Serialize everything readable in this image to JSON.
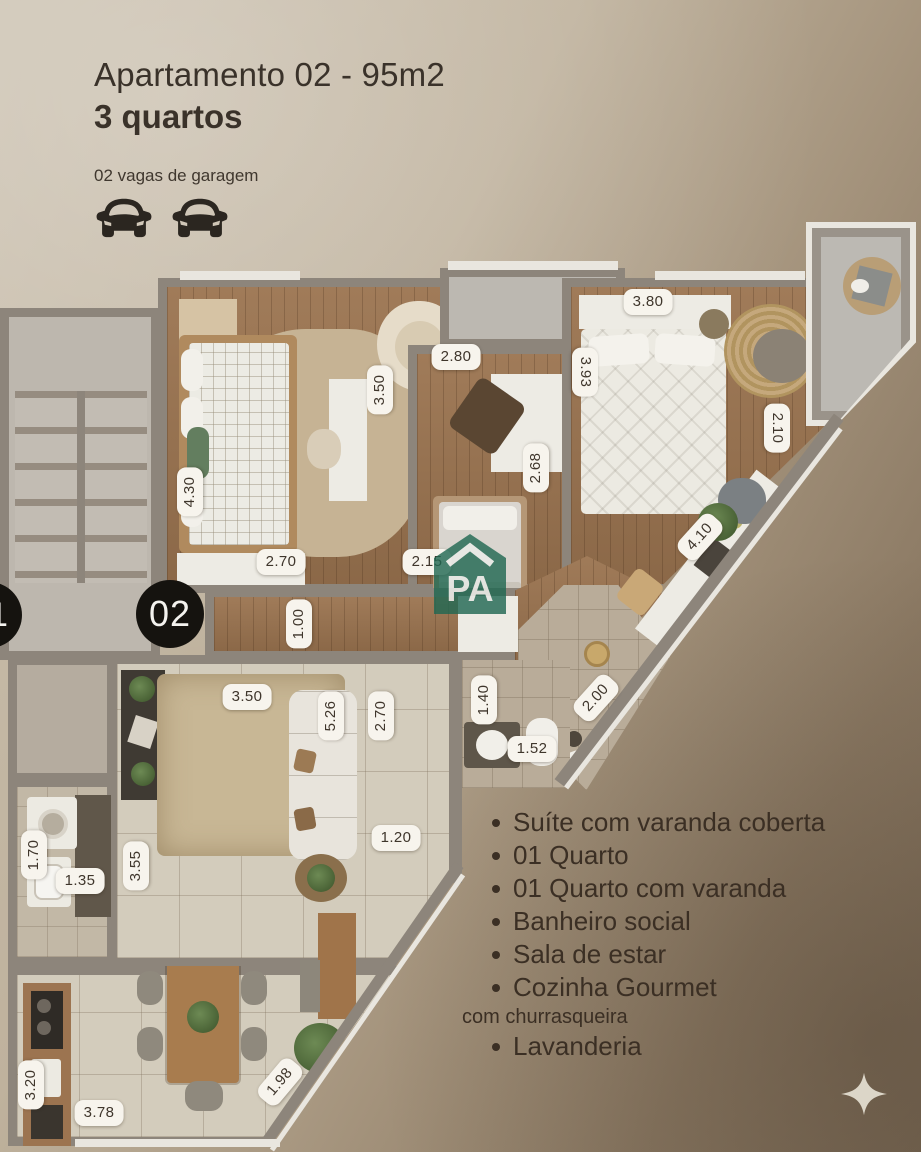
{
  "header": {
    "title": "Apartamento 02 - 95m2",
    "subtitle": "3 quartos",
    "garage_label": "02 vagas de garagem",
    "garage_count": 2
  },
  "unit_badge": {
    "current": "02",
    "previous": "01"
  },
  "logo": {
    "text": "PA",
    "color": "#1f6e57"
  },
  "features": {
    "items": [
      {
        "label": "Suíte com varanda coberta",
        "bullet": true,
        "small": false
      },
      {
        "label": "01 Quarto",
        "bullet": true,
        "small": false
      },
      {
        "label": "01 Quarto com varanda",
        "bullet": true,
        "small": false
      },
      {
        "label": "Banheiro social",
        "bullet": true,
        "small": false
      },
      {
        "label": "Sala de estar",
        "bullet": true,
        "small": false
      },
      {
        "label": "Cozinha Gourmet",
        "bullet": true,
        "small": false
      },
      {
        "label": "com churrasqueira",
        "bullet": false,
        "small": true
      },
      {
        "label": "Lavanderia",
        "bullet": true,
        "small": false
      }
    ]
  },
  "measurements": [
    {
      "room": "quarto-1",
      "value": "4.30",
      "x": 190,
      "y": 492,
      "rot": -90
    },
    {
      "room": "quarto-1",
      "value": "2.70",
      "x": 281,
      "y": 562,
      "rot": 0
    },
    {
      "room": "varanda-quarto-2",
      "value": "3.50",
      "x": 380,
      "y": 390,
      "rot": -90
    },
    {
      "room": "quarto-2",
      "value": "2.80",
      "x": 456,
      "y": 357,
      "rot": 0
    },
    {
      "room": "quarto-2",
      "value": "2.68",
      "x": 536,
      "y": 468,
      "rot": -90
    },
    {
      "room": "quarto-2",
      "value": "2.15",
      "x": 427,
      "y": 562,
      "rot": 0
    },
    {
      "room": "suite",
      "value": "3.80",
      "x": 648,
      "y": 302,
      "rot": 0
    },
    {
      "room": "suite",
      "value": "3.93",
      "x": 585,
      "y": 372,
      "rot": 90
    },
    {
      "room": "suite",
      "value": "2.10",
      "x": 777,
      "y": 428,
      "rot": 90
    },
    {
      "room": "suite",
      "value": "4.10",
      "x": 700,
      "y": 537,
      "rot": -48
    },
    {
      "room": "hall",
      "value": "1.00",
      "x": 299,
      "y": 624,
      "rot": -90
    },
    {
      "room": "banheiro-suite",
      "value": "2.00",
      "x": 596,
      "y": 698,
      "rot": -48
    },
    {
      "room": "banheiro",
      "value": "1.40",
      "x": 484,
      "y": 700,
      "rot": -90
    },
    {
      "room": "banheiro",
      "value": "1.52",
      "x": 532,
      "y": 749,
      "rot": 0
    },
    {
      "room": "banheiro-social",
      "value": "2.70",
      "x": 381,
      "y": 716,
      "rot": -90
    },
    {
      "room": "banheiro-social",
      "value": "1.20",
      "x": 396,
      "y": 838,
      "rot": 0
    },
    {
      "room": "sala",
      "value": "3.50",
      "x": 247,
      "y": 697,
      "rot": 0
    },
    {
      "room": "sala",
      "value": "5.26",
      "x": 331,
      "y": 716,
      "rot": -90
    },
    {
      "room": "sala",
      "value": "3.55",
      "x": 136,
      "y": 866,
      "rot": -90
    },
    {
      "room": "lavanderia",
      "value": "1.70",
      "x": 34,
      "y": 855,
      "rot": -90
    },
    {
      "room": "lavanderia",
      "value": "1.35",
      "x": 80,
      "y": 881,
      "rot": 0
    },
    {
      "room": "cozinha",
      "value": "3.20",
      "x": 31,
      "y": 1085,
      "rot": -90
    },
    {
      "room": "cozinha",
      "value": "3.78",
      "x": 99,
      "y": 1113,
      "rot": 0
    },
    {
      "room": "cozinha",
      "value": "1.98",
      "x": 280,
      "y": 1082,
      "rot": -50
    }
  ],
  "icons": {
    "garage": "car-icon",
    "decoration": "sparkle-icon"
  },
  "colors": {
    "background_light": "#cbc1b0",
    "background_dark": "#7d6c58",
    "text": "#3a322a",
    "chip_bg": "#f7f4ed",
    "badge_bg": "#15130f",
    "logo_green": "#1f6e57",
    "wall": "#8d857b",
    "wood_floor": "#9b7450"
  }
}
